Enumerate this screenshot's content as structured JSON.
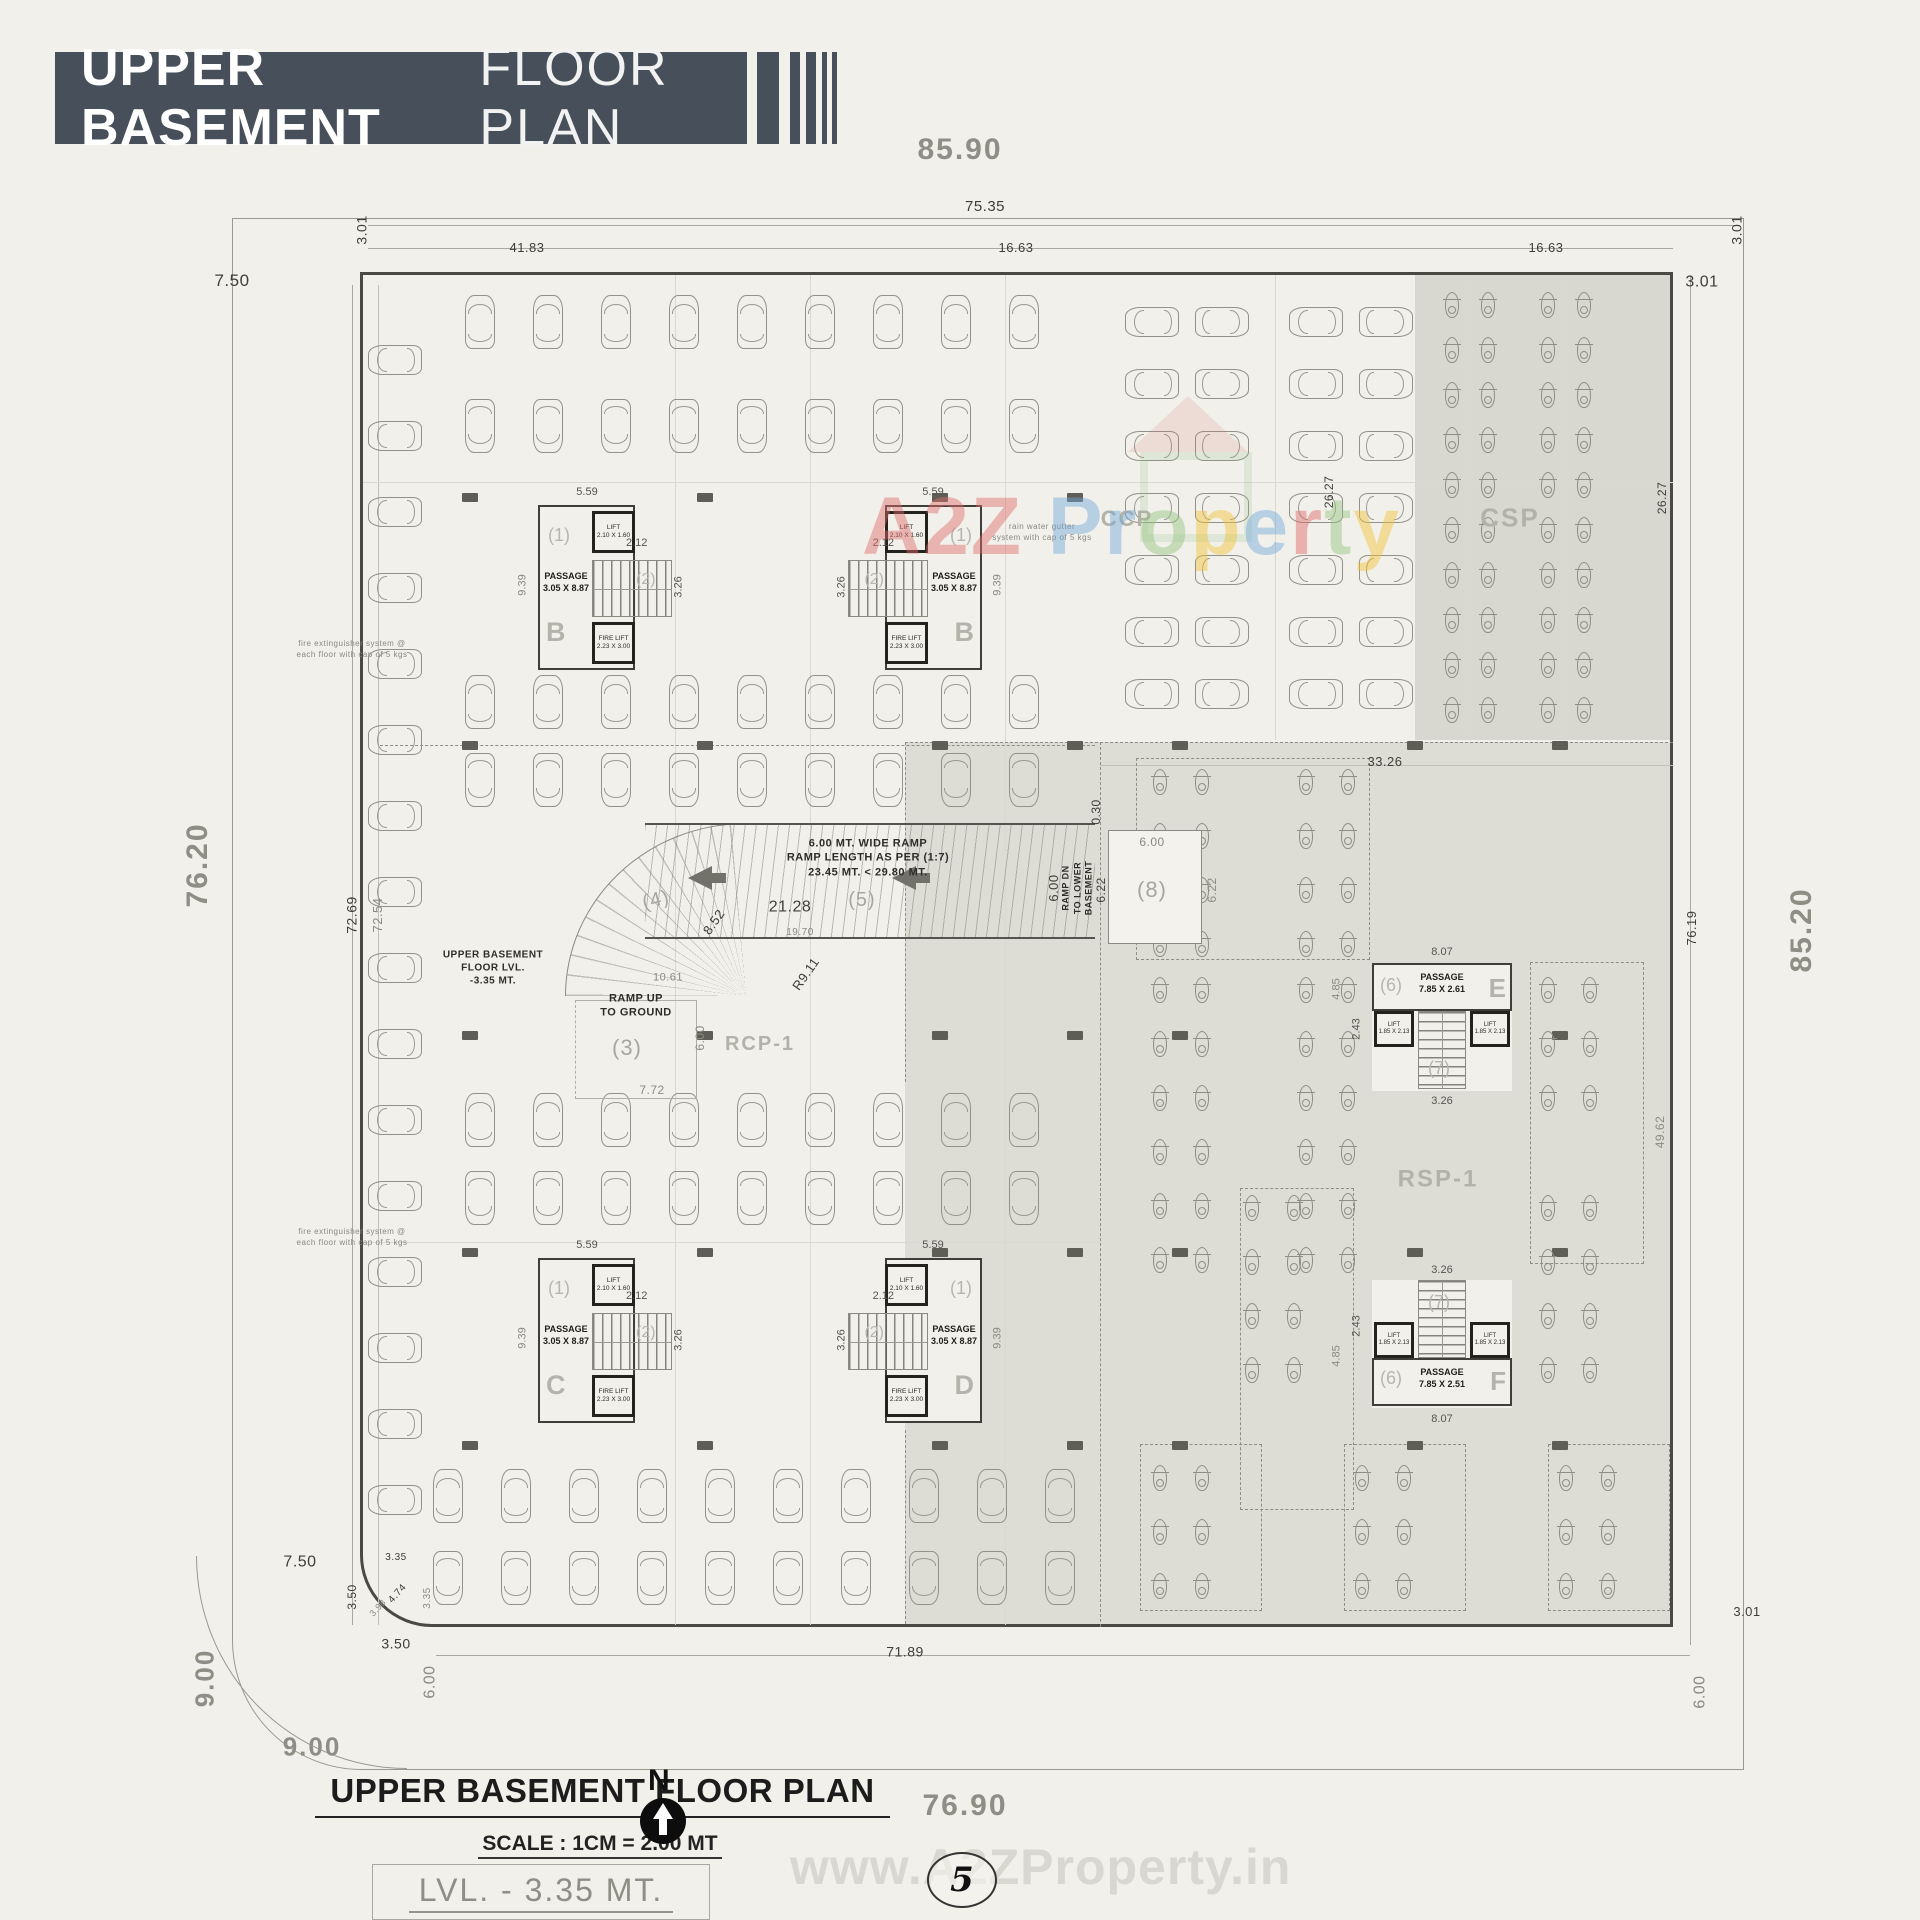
{
  "header": {
    "title_strong": "UPPER BASEMENT",
    "title_light": "FLOOR PLAN"
  },
  "footer": {
    "plan_title": "UPPER BASEMENT FLOOR PLAN",
    "scale": "SCALE : 1CM = 2.00 MT",
    "level": "LVL. - 3.35 MT.",
    "north_label": "N",
    "page_number": "5"
  },
  "watermarks": {
    "site": "www.A2ZProperty.in",
    "brand_letters": [
      {
        "ch": "A",
        "c": "#e06a6a"
      },
      {
        "ch": "2",
        "c": "#e06a6a"
      },
      {
        "ch": "Z",
        "c": "#e06a6a"
      },
      {
        "ch": " ",
        "c": "#e06a6a"
      },
      {
        "ch": "P",
        "c": "#6fa8dc"
      },
      {
        "ch": "r",
        "c": "#6fa8dc"
      },
      {
        "ch": "o",
        "c": "#93c47d"
      },
      {
        "ch": "p",
        "c": "#f1c232"
      },
      {
        "ch": "e",
        "c": "#6fa8dc"
      },
      {
        "ch": "r",
        "c": "#e06666"
      },
      {
        "ch": "t",
        "c": "#93c47d"
      },
      {
        "ch": "y",
        "c": "#f1c232"
      }
    ]
  },
  "cores": {
    "shared_b": {
      "label1": "(1)",
      "label2": "(2)",
      "passage": "PASSAGE\n3.05 X 8.87",
      "lift": "LIFT\n2.10 X 1.60",
      "fire": "FIRE LIFT\n2.23 X 3.00",
      "d559": "5.59",
      "d212": "2.12",
      "d326": "3.26",
      "d939": "9.39"
    },
    "b1": {
      "letter": "B"
    },
    "b2": {
      "letter": "B"
    },
    "c": {
      "letter": "C"
    },
    "d": {
      "letter": "D"
    },
    "shared_ef": {
      "label6": "(6)",
      "label7": "(7)",
      "lift": "LIFT\n1.85 X 2.13",
      "d807": "8.07",
      "d243": "2.43",
      "d326": "3.26",
      "d485": "4.85"
    },
    "e": {
      "letter": "E",
      "passage": "PASSAGE\n7.85 X 2.61"
    },
    "f": {
      "letter": "F",
      "passage": "PASSAGE\n7.85 X 2.51"
    }
  },
  "plan": {
    "labels": [
      {
        "t": "85.90",
        "x": 960,
        "y": 150,
        "s": 30,
        "cls": "big"
      },
      {
        "t": "75.35",
        "x": 985,
        "y": 207,
        "s": 15
      },
      {
        "t": "7.50",
        "x": 232,
        "y": 281,
        "s": 17
      },
      {
        "t": "41.83",
        "x": 527,
        "y": 248,
        "s": 13
      },
      {
        "t": "16.63",
        "x": 1016,
        "y": 248,
        "s": 13
      },
      {
        "t": "16.63",
        "x": 1546,
        "y": 248,
        "s": 13
      },
      {
        "t": "3.01",
        "x": 1702,
        "y": 282,
        "s": 16
      },
      {
        "t": "3.01",
        "x": 362,
        "y": 230,
        "s": 14,
        "r": -90
      },
      {
        "t": "3.01",
        "x": 1737,
        "y": 230,
        "s": 14,
        "r": -90
      },
      {
        "t": "76.20",
        "x": 198,
        "y": 865,
        "s": 30,
        "r": -90,
        "cls": "big"
      },
      {
        "t": "72.69",
        "x": 352,
        "y": 915,
        "s": 14,
        "r": -90
      },
      {
        "t": "72.54",
        "x": 378,
        "y": 915,
        "s": 13,
        "r": -90,
        "cls": "dimg"
      },
      {
        "t": "26.27",
        "x": 1329,
        "y": 492,
        "s": 12,
        "r": -90
      },
      {
        "t": "26.27",
        "x": 1662,
        "y": 498,
        "s": 12,
        "r": -90
      },
      {
        "t": "33.26",
        "x": 1385,
        "y": 762,
        "s": 13
      },
      {
        "t": "76.19",
        "x": 1692,
        "y": 928,
        "s": 13,
        "r": -90
      },
      {
        "t": "85.20",
        "x": 1802,
        "y": 930,
        "s": 30,
        "r": -90,
        "cls": "big"
      },
      {
        "t": "49.62",
        "x": 1660,
        "y": 1132,
        "s": 12,
        "r": -90,
        "cls": "dimg"
      },
      {
        "t": "71.89",
        "x": 905,
        "y": 1652,
        "s": 14
      },
      {
        "t": "7.50",
        "x": 300,
        "y": 1562,
        "s": 16
      },
      {
        "t": "3.50",
        "x": 352,
        "y": 1597,
        "s": 12,
        "r": -90
      },
      {
        "t": "3.35",
        "x": 396,
        "y": 1558,
        "s": 10
      },
      {
        "t": "4.74",
        "x": 398,
        "y": 1594,
        "s": 10,
        "r": -48
      },
      {
        "t": "3.98",
        "x": 378,
        "y": 1608,
        "s": 9,
        "r": -48,
        "cls": "dimg"
      },
      {
        "t": "3.35",
        "x": 428,
        "y": 1598,
        "s": 10,
        "r": -90,
        "cls": "dimg"
      },
      {
        "t": "3.50",
        "x": 396,
        "y": 1644,
        "s": 14
      },
      {
        "t": "6.00",
        "x": 430,
        "y": 1682,
        "s": 16,
        "r": -90,
        "cls": "dimg"
      },
      {
        "t": "9.00",
        "x": 205,
        "y": 1678,
        "s": 26,
        "r": -90,
        "cls": "big"
      },
      {
        "t": "9.00",
        "x": 312,
        "y": 1747,
        "s": 26,
        "cls": "big"
      },
      {
        "t": "76.90",
        "x": 965,
        "y": 1806,
        "s": 30,
        "cls": "big"
      },
      {
        "t": "6.00",
        "x": 1700,
        "y": 1692,
        "s": 16,
        "r": -90,
        "cls": "dimg"
      },
      {
        "t": "3.01",
        "x": 1747,
        "y": 1612,
        "s": 13
      },
      {
        "t": "21.28",
        "x": 790,
        "y": 907,
        "s": 16
      },
      {
        "t": "19.70",
        "x": 800,
        "y": 933,
        "s": 10,
        "cls": "dimg"
      },
      {
        "t": "6.00",
        "x": 1152,
        "y": 842,
        "s": 12,
        "cls": "dimg"
      },
      {
        "t": "6.22",
        "x": 1101,
        "y": 890,
        "s": 12,
        "r": -90
      },
      {
        "t": "6.22",
        "x": 1212,
        "y": 890,
        "s": 12,
        "r": -90,
        "cls": "dimg"
      },
      {
        "t": "0.30",
        "x": 1096,
        "y": 812,
        "s": 12,
        "r": -90
      },
      {
        "t": "10.61",
        "x": 668,
        "y": 978,
        "s": 11,
        "cls": "dimg"
      },
      {
        "t": "7.72",
        "x": 652,
        "y": 1090,
        "s": 12,
        "cls": "dimg"
      },
      {
        "t": "6.00",
        "x": 700,
        "y": 1038,
        "s": 12,
        "r": -90,
        "cls": "dimg"
      },
      {
        "t": "8.52",
        "x": 714,
        "y": 922,
        "s": 13,
        "r": -55
      },
      {
        "t": "R9.11",
        "x": 806,
        "y": 974,
        "s": 13,
        "r": -55
      },
      {
        "t": "(4)",
        "x": 656,
        "y": 900,
        "s": 20,
        "r": -15,
        "cls": "area2"
      },
      {
        "t": "(3)",
        "x": 627,
        "y": 1048,
        "s": 22,
        "cls": "area2"
      },
      {
        "t": "(5)",
        "x": 862,
        "y": 900,
        "s": 20,
        "cls": "area2"
      },
      {
        "t": "(8)",
        "x": 1152,
        "y": 890,
        "s": 22,
        "cls": "area2"
      },
      {
        "t": "RCP-1",
        "x": 760,
        "y": 1044,
        "s": 20,
        "cls": "area"
      },
      {
        "t": "RSP-1",
        "x": 1438,
        "y": 1180,
        "s": 24,
        "cls": "area"
      },
      {
        "t": "CSP",
        "x": 1510,
        "y": 518,
        "s": 26,
        "cls": "area"
      },
      {
        "t": "CCP",
        "x": 1127,
        "y": 519,
        "s": 22,
        "cls": "area"
      },
      {
        "t": "rain water gutter\nsystem with cap of 5 kgs",
        "x": 1042,
        "y": 533,
        "s": 8,
        "cls": "note"
      },
      {
        "t": "fire extinguisher system @\neach floor with cap of 5 kgs",
        "x": 352,
        "y": 650,
        "s": 8,
        "cls": "note"
      },
      {
        "t": "fire extinguisher system @\neach floor with cap of 5 kgs",
        "x": 352,
        "y": 1238,
        "s": 8,
        "cls": "note"
      },
      {
        "t": "UPPER BASEMENT\nFLOOR LVL.\n-3.35 MT.",
        "x": 493,
        "y": 968,
        "s": 10,
        "cls": "darknote"
      },
      {
        "t": "RAMP UP\nTO GROUND",
        "x": 636,
        "y": 1006,
        "s": 11,
        "cls": "darknote"
      },
      {
        "t": "6.00 MT. WIDE RAMP\nRAMP LENGTH AS PER (1:7)\n23.45 MT. < 29.80 MT.",
        "x": 868,
        "y": 858,
        "s": 11,
        "cls": "darknote"
      },
      {
        "t": "RAMP DN\nTO LOWER\nBASEMENT",
        "x": 1078,
        "y": 888,
        "s": 9,
        "r": -90,
        "cls": "darknote"
      },
      {
        "t": "6.00",
        "x": 1054,
        "y": 888,
        "s": 13,
        "r": -90
      }
    ],
    "car_rows": [
      {
        "cx": 395,
        "cy": 360,
        "n": 16,
        "dx": 0,
        "dy": 76,
        "rot": -90
      },
      {
        "cx": 480,
        "cy": 322,
        "n": 9,
        "dx": 68,
        "dy": 0,
        "rot": 0
      },
      {
        "cx": 480,
        "cy": 426,
        "n": 9,
        "dx": 68,
        "dy": 0,
        "rot": 180
      },
      {
        "cx": 480,
        "cy": 702,
        "n": 9,
        "dx": 68,
        "dy": 0,
        "rot": 0
      },
      {
        "cx": 480,
        "cy": 780,
        "n": 9,
        "dx": 68,
        "dy": 0,
        "rot": 180
      },
      {
        "cx": 480,
        "cy": 1120,
        "n": 9,
        "dx": 68,
        "dy": 0,
        "rot": 0
      },
      {
        "cx": 480,
        "cy": 1198,
        "n": 9,
        "dx": 68,
        "dy": 0,
        "rot": 180
      },
      {
        "cx": 448,
        "cy": 1496,
        "n": 10,
        "dx": 68,
        "dy": 0,
        "rot": 0
      },
      {
        "cx": 448,
        "cy": 1578,
        "n": 10,
        "dx": 68,
        "dy": 0,
        "rot": 180
      },
      {
        "cx": 1152,
        "cy": 322,
        "n": 7,
        "dx": 0,
        "dy": 62,
        "rot": -90
      },
      {
        "cx": 1222,
        "cy": 322,
        "n": 7,
        "dx": 0,
        "dy": 62,
        "rot": 90
      },
      {
        "cx": 1316,
        "cy": 322,
        "n": 7,
        "dx": 0,
        "dy": 62,
        "rot": -90
      },
      {
        "cx": 1386,
        "cy": 322,
        "n": 7,
        "dx": 0,
        "dy": 62,
        "rot": 90
      }
    ],
    "bike_cols": [
      {
        "cx": 1452,
        "cy": 305,
        "n": 10,
        "dy": 45
      },
      {
        "cx": 1488,
        "cy": 305,
        "n": 10,
        "dy": 45
      },
      {
        "cx": 1548,
        "cy": 305,
        "n": 10,
        "dy": 45
      },
      {
        "cx": 1584,
        "cy": 305,
        "n": 10,
        "dy": 45
      },
      {
        "cx": 1160,
        "cy": 782,
        "n": 4,
        "dy": 54
      },
      {
        "cx": 1202,
        "cy": 782,
        "n": 4,
        "dy": 54
      },
      {
        "cx": 1306,
        "cy": 782,
        "n": 4,
        "dy": 54
      },
      {
        "cx": 1348,
        "cy": 782,
        "n": 4,
        "dy": 54
      },
      {
        "cx": 1160,
        "cy": 990,
        "n": 6,
        "dy": 54
      },
      {
        "cx": 1202,
        "cy": 990,
        "n": 6,
        "dy": 54
      },
      {
        "cx": 1306,
        "cy": 990,
        "n": 6,
        "dy": 54
      },
      {
        "cx": 1348,
        "cy": 990,
        "n": 6,
        "dy": 54
      },
      {
        "cx": 1548,
        "cy": 990,
        "n": 3,
        "dy": 54
      },
      {
        "cx": 1590,
        "cy": 990,
        "n": 3,
        "dy": 54
      },
      {
        "cx": 1252,
        "cy": 1208,
        "n": 4,
        "dy": 54
      },
      {
        "cx": 1294,
        "cy": 1208,
        "n": 4,
        "dy": 54
      },
      {
        "cx": 1548,
        "cy": 1208,
        "n": 4,
        "dy": 54
      },
      {
        "cx": 1590,
        "cy": 1208,
        "n": 4,
        "dy": 54
      },
      {
        "cx": 1160,
        "cy": 1478,
        "n": 3,
        "dy": 54
      },
      {
        "cx": 1202,
        "cy": 1478,
        "n": 3,
        "dy": 54
      },
      {
        "cx": 1362,
        "cy": 1478,
        "n": 3,
        "dy": 54
      },
      {
        "cx": 1404,
        "cy": 1478,
        "n": 3,
        "dy": 54
      },
      {
        "cx": 1566,
        "cy": 1478,
        "n": 3,
        "dy": 54
      },
      {
        "cx": 1608,
        "cy": 1478,
        "n": 3,
        "dy": 54
      }
    ],
    "columns": [
      [
        470,
        497
      ],
      [
        705,
        497
      ],
      [
        940,
        497
      ],
      [
        1075,
        497
      ],
      [
        470,
        745
      ],
      [
        705,
        745
      ],
      [
        940,
        745
      ],
      [
        1075,
        745
      ],
      [
        470,
        1035
      ],
      [
        705,
        1035
      ],
      [
        940,
        1035
      ],
      [
        1075,
        1035
      ],
      [
        470,
        1252
      ],
      [
        705,
        1252
      ],
      [
        940,
        1252
      ],
      [
        1075,
        1252
      ],
      [
        470,
        1445
      ],
      [
        705,
        1445
      ],
      [
        940,
        1445
      ],
      [
        1075,
        1445
      ],
      [
        1180,
        745
      ],
      [
        1415,
        745
      ],
      [
        1560,
        745
      ],
      [
        1180,
        1035
      ],
      [
        1415,
        1035
      ],
      [
        1560,
        1035
      ],
      [
        1180,
        1252
      ],
      [
        1415,
        1252
      ],
      [
        1560,
        1252
      ],
      [
        1180,
        1445
      ],
      [
        1415,
        1445
      ],
      [
        1560,
        1445
      ]
    ],
    "lines": [
      {
        "x": 368,
        "y": 225,
        "w": 1372,
        "h": 1
      },
      {
        "x": 368,
        "y": 248,
        "w": 1305,
        "h": 1
      },
      {
        "x": 352,
        "y": 285,
        "w": 1,
        "h": 1340
      },
      {
        "x": 378,
        "y": 285,
        "w": 1,
        "h": 1340,
        "cls": "l2"
      },
      {
        "x": 1690,
        "y": 275,
        "w": 1,
        "h": 1370
      },
      {
        "x": 436,
        "y": 1655,
        "w": 1254,
        "h": 1
      },
      {
        "x": 1100,
        "y": 765,
        "w": 573,
        "h": 1,
        "cls": "l2"
      },
      {
        "x": 675,
        "y": 275,
        "w": 1,
        "h": 1350,
        "cls": "lg"
      },
      {
        "x": 810,
        "y": 275,
        "w": 1,
        "h": 1350,
        "cls": "lg"
      },
      {
        "x": 1005,
        "y": 275,
        "w": 1,
        "h": 1350,
        "cls": "lg"
      },
      {
        "x": 1275,
        "y": 275,
        "w": 1,
        "h": 465,
        "cls": "lg"
      },
      {
        "x": 1470,
        "y": 275,
        "w": 1,
        "h": 465,
        "cls": "lg"
      },
      {
        "x": 1566,
        "y": 275,
        "w": 1,
        "h": 465,
        "cls": "lg"
      },
      {
        "x": 363,
        "y": 482,
        "w": 1310,
        "h": 1,
        "cls": "lg"
      },
      {
        "x": 363,
        "y": 1242,
        "w": 740,
        "h": 1,
        "cls": "lg"
      },
      {
        "x": 380,
        "y": 745,
        "w": 715,
        "h": 1,
        "cls": "ld"
      },
      {
        "x": 905,
        "y": 742,
        "w": 768,
        "h": 1,
        "cls": "ld"
      },
      {
        "x": 905,
        "y": 742,
        "w": 1,
        "h": 340,
        "cls": "ld"
      },
      {
        "x": 905,
        "y": 1430,
        "w": 1,
        "h": 194,
        "cls": "ld"
      },
      {
        "x": 1100,
        "y": 742,
        "w": 1,
        "h": 885,
        "cls": "ld"
      }
    ],
    "boxes": [
      {
        "x": 1136,
        "y": 758,
        "w": 232,
        "h": 200
      },
      {
        "x": 1240,
        "y": 1188,
        "w": 112,
        "h": 320
      },
      {
        "x": 1530,
        "y": 962,
        "w": 112,
        "h": 300
      },
      {
        "x": 1140,
        "y": 1444,
        "w": 120,
        "h": 165
      },
      {
        "x": 1344,
        "y": 1444,
        "w": 120,
        "h": 165
      },
      {
        "x": 1548,
        "y": 1444,
        "w": 120,
        "h": 165
      }
    ]
  }
}
